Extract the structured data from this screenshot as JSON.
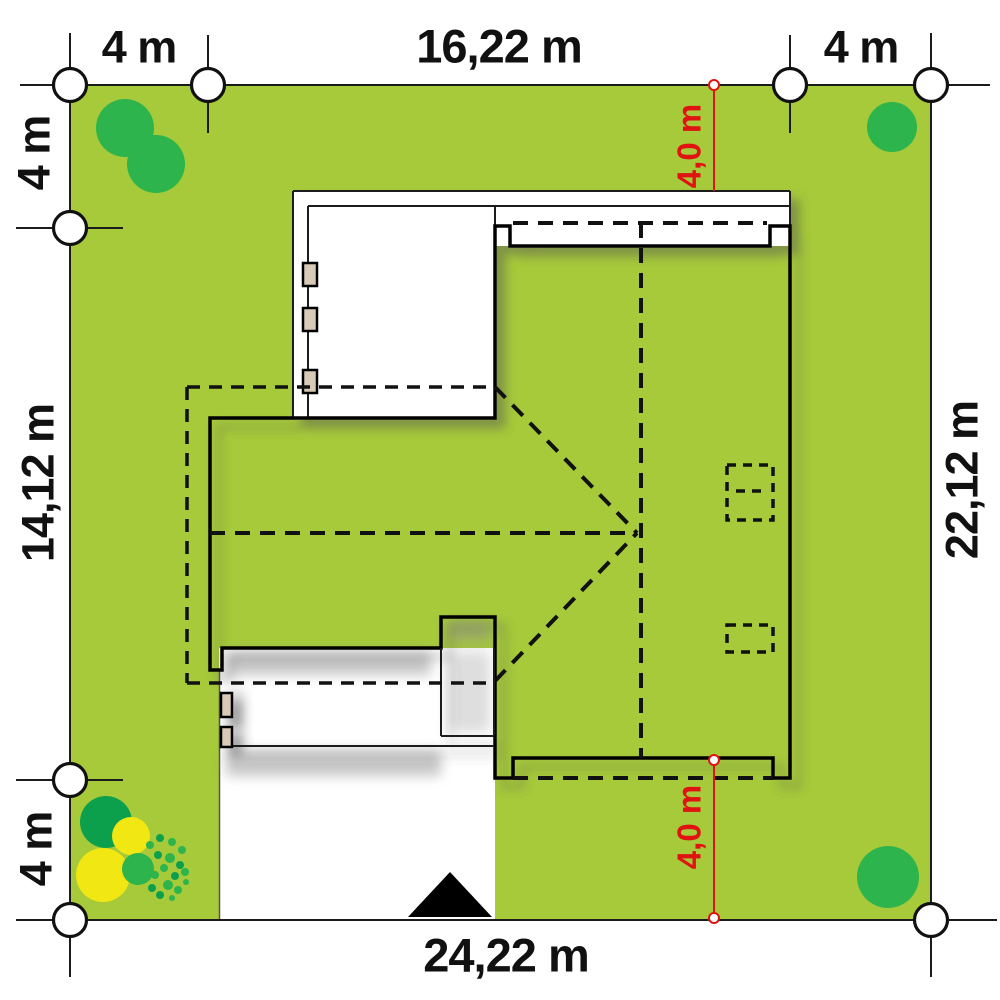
{
  "title": "House site plan with plot dimensions",
  "labels": {
    "top_left": "4 m",
    "top_center": "16,22 m",
    "top_right": "4 m",
    "left_top": "4 m",
    "left_middle": "14,12 m",
    "left_bottom": "4 m",
    "right_side": "22,12 m",
    "bottom": "24,22 m",
    "setback_top": "4,0 m",
    "setback_bottom": "4,0 m"
  },
  "colors": {
    "lawn": "#a6ca3a",
    "roof": "#d8cab7",
    "tree": "#2db44c",
    "tree-dark": "#0da04c",
    "shrub-yellow": "#f1e713",
    "dim-red": "#e01212",
    "label": "#111111"
  }
}
